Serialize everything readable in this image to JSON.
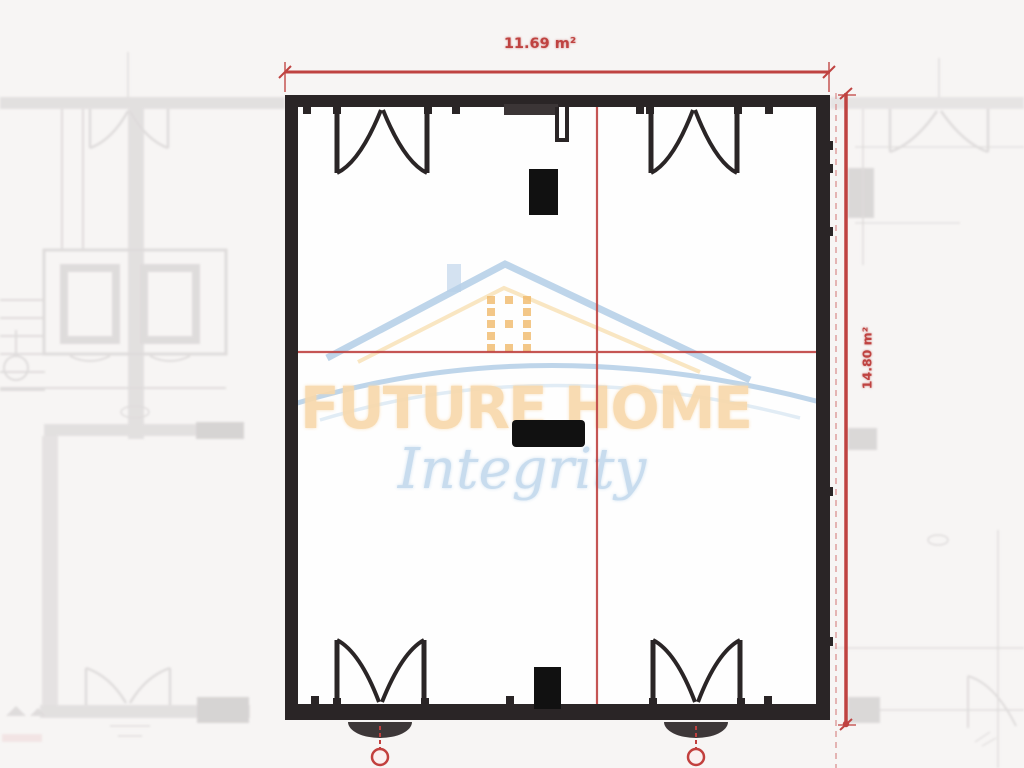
{
  "watermark": {
    "brand": "FUTURE HOME",
    "tagline": "Integrity",
    "logo_icon": "house-roof-icon"
  },
  "dimensions": {
    "width_label": "11.69 m²",
    "height_label": "14.80 m²"
  },
  "colors": {
    "wall": "#2a2526",
    "dimension_red": "#bf4341",
    "dimension_red_light": "#d98f8f",
    "brand_orange": "#f8d9ac",
    "brand_blue": "#c6dbee",
    "logo_blue": "#b7d0e8",
    "logo_orange": "#f1ba6b",
    "faded_plan_gray": "#d9d6d6"
  }
}
